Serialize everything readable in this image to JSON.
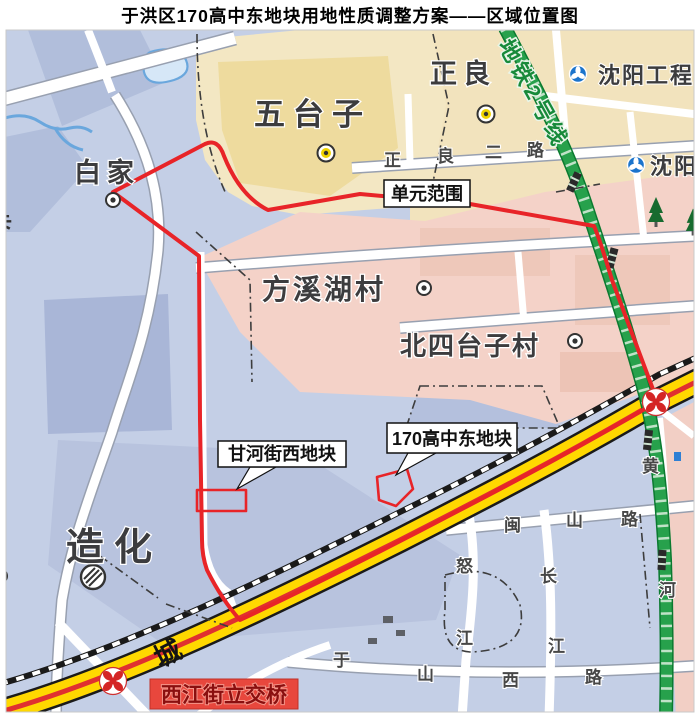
{
  "title": "于洪区170高中东地块用地性质调整方案——区域位置图",
  "map": {
    "areas": {
      "baijia": "白家",
      "wutaizi": "五台子",
      "zhengliang": "正良",
      "fangxihucun": "方溪湖村",
      "beisitaizicun": "北四台子村",
      "zaohua": "造化",
      "cheng": "城",
      "ka": "卡"
    },
    "callouts": {
      "unit_scope": "单元范围",
      "ganhe_west_plot": "甘河街西地块",
      "plot_170": "170高中东地块",
      "overpass": "西江街立交桥"
    },
    "metro": {
      "line2": "地铁2号线",
      "station_gongcheng": "沈阳工程",
      "station_shen": "沈阳"
    },
    "roads": {
      "zhengliang2": [
        "正",
        "良",
        "二",
        "路"
      ],
      "minshan": [
        "闽",
        "山",
        "路"
      ],
      "nujiang": [
        "怒",
        "江"
      ],
      "changjiang": [
        "长",
        "江"
      ],
      "yushanxi": [
        "于",
        "山",
        "西",
        "路"
      ],
      "huanghe": [
        "黄",
        "河"
      ]
    }
  }
}
